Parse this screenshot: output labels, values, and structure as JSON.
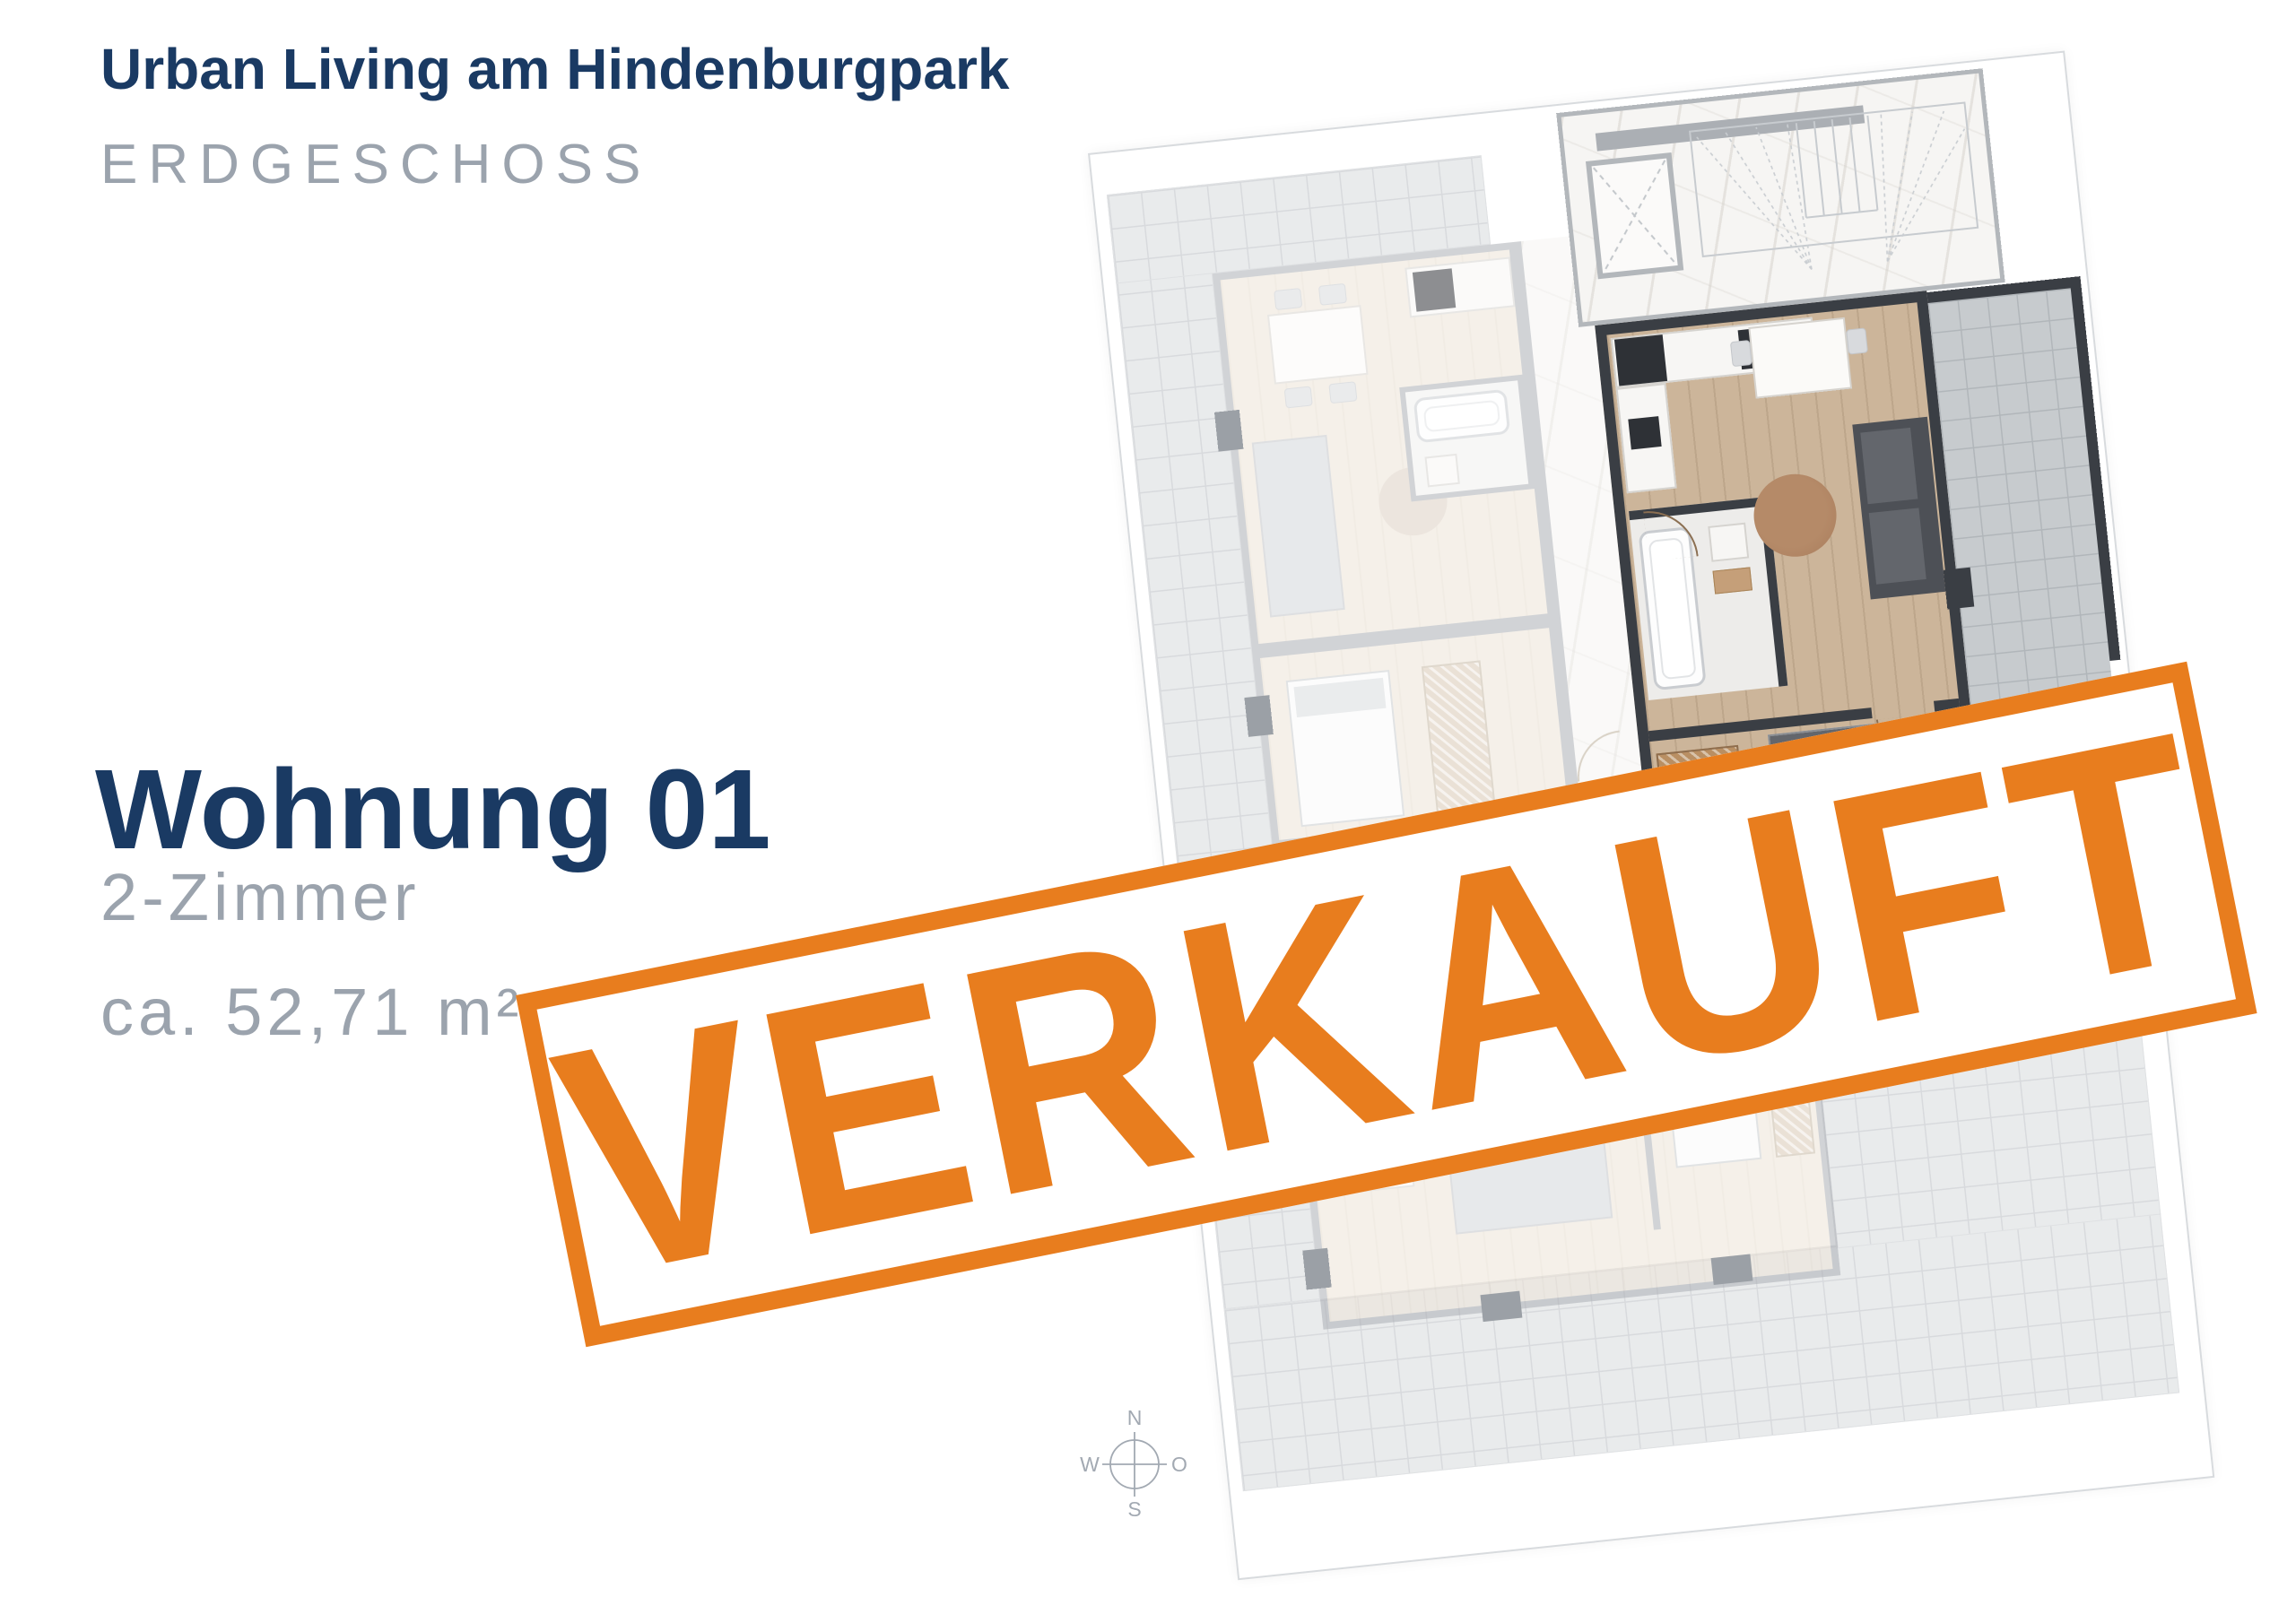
{
  "header": {
    "project_title": "Urban Living am Hindenburgpark",
    "floor_label": "ERDGESCHOSS"
  },
  "apartment": {
    "name": "Wohnung 01",
    "rooms": "2-Zimmer",
    "area": "ca. 52,71 m²"
  },
  "stamp": {
    "label": "VERKAUFT"
  },
  "compass": {
    "north": "N",
    "east": "O",
    "south": "S",
    "west": "W"
  },
  "colors": {
    "navy": "#1A3A63",
    "muted_gray": "#9BA3AD",
    "stamp_orange": "#E87D1E",
    "wall_light": "#ABAFB4",
    "wall_dark": "#3A3E44",
    "wood_highlight": "#CCB59A"
  }
}
